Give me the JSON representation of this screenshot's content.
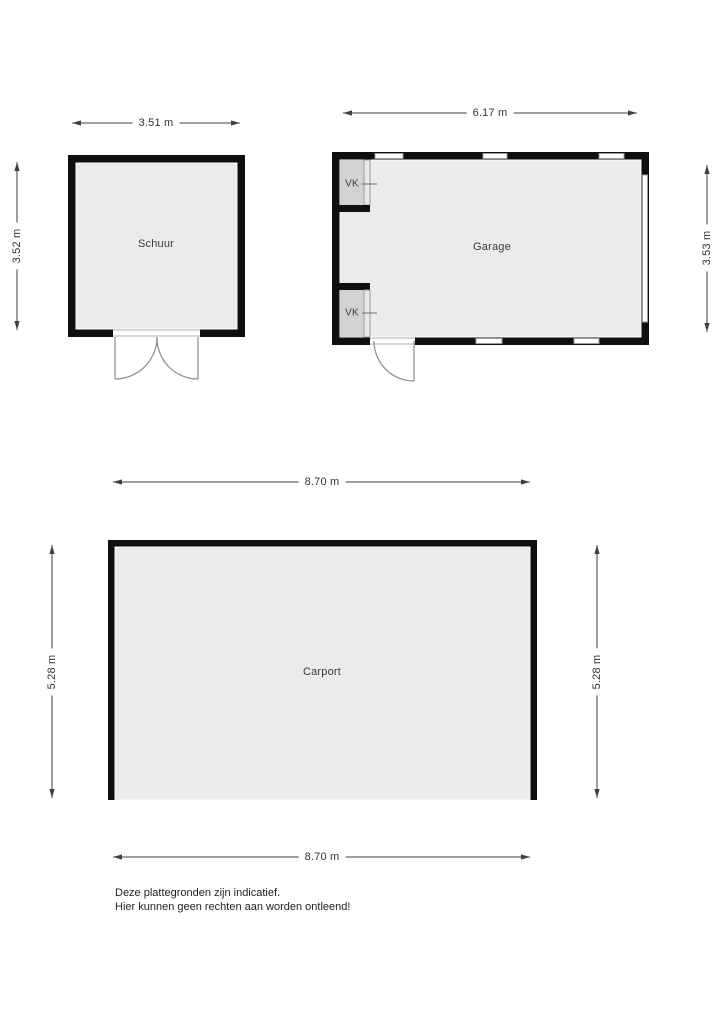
{
  "rooms": {
    "schuur": {
      "label": "Schuur",
      "width": "3.51 m",
      "height": "3.52 m"
    },
    "garage": {
      "label": "Garage",
      "width": "6.17 m",
      "height": "3.53 m",
      "vk_top_label": "VK",
      "vk_bottom_label": "VK"
    },
    "carport": {
      "label": "Carport",
      "width_top": "8.70 m",
      "width_bottom": "8.70 m",
      "height_left": "5.28 m",
      "height_right": "5.28 m"
    }
  },
  "disclaimer": {
    "line1": "Deze plattegronden zijn indicatief.",
    "line2": "Hier kunnen geen rechten aan worden ontleend!"
  },
  "colors": {
    "wall": "#0f0f0f",
    "floor": "#ebebeb",
    "vk_floor": "#d2d2d2",
    "window": "#9a9a9a",
    "door": "#8c8c8c",
    "dimension": "#3f3f3f",
    "text": "#3a3a3a"
  }
}
